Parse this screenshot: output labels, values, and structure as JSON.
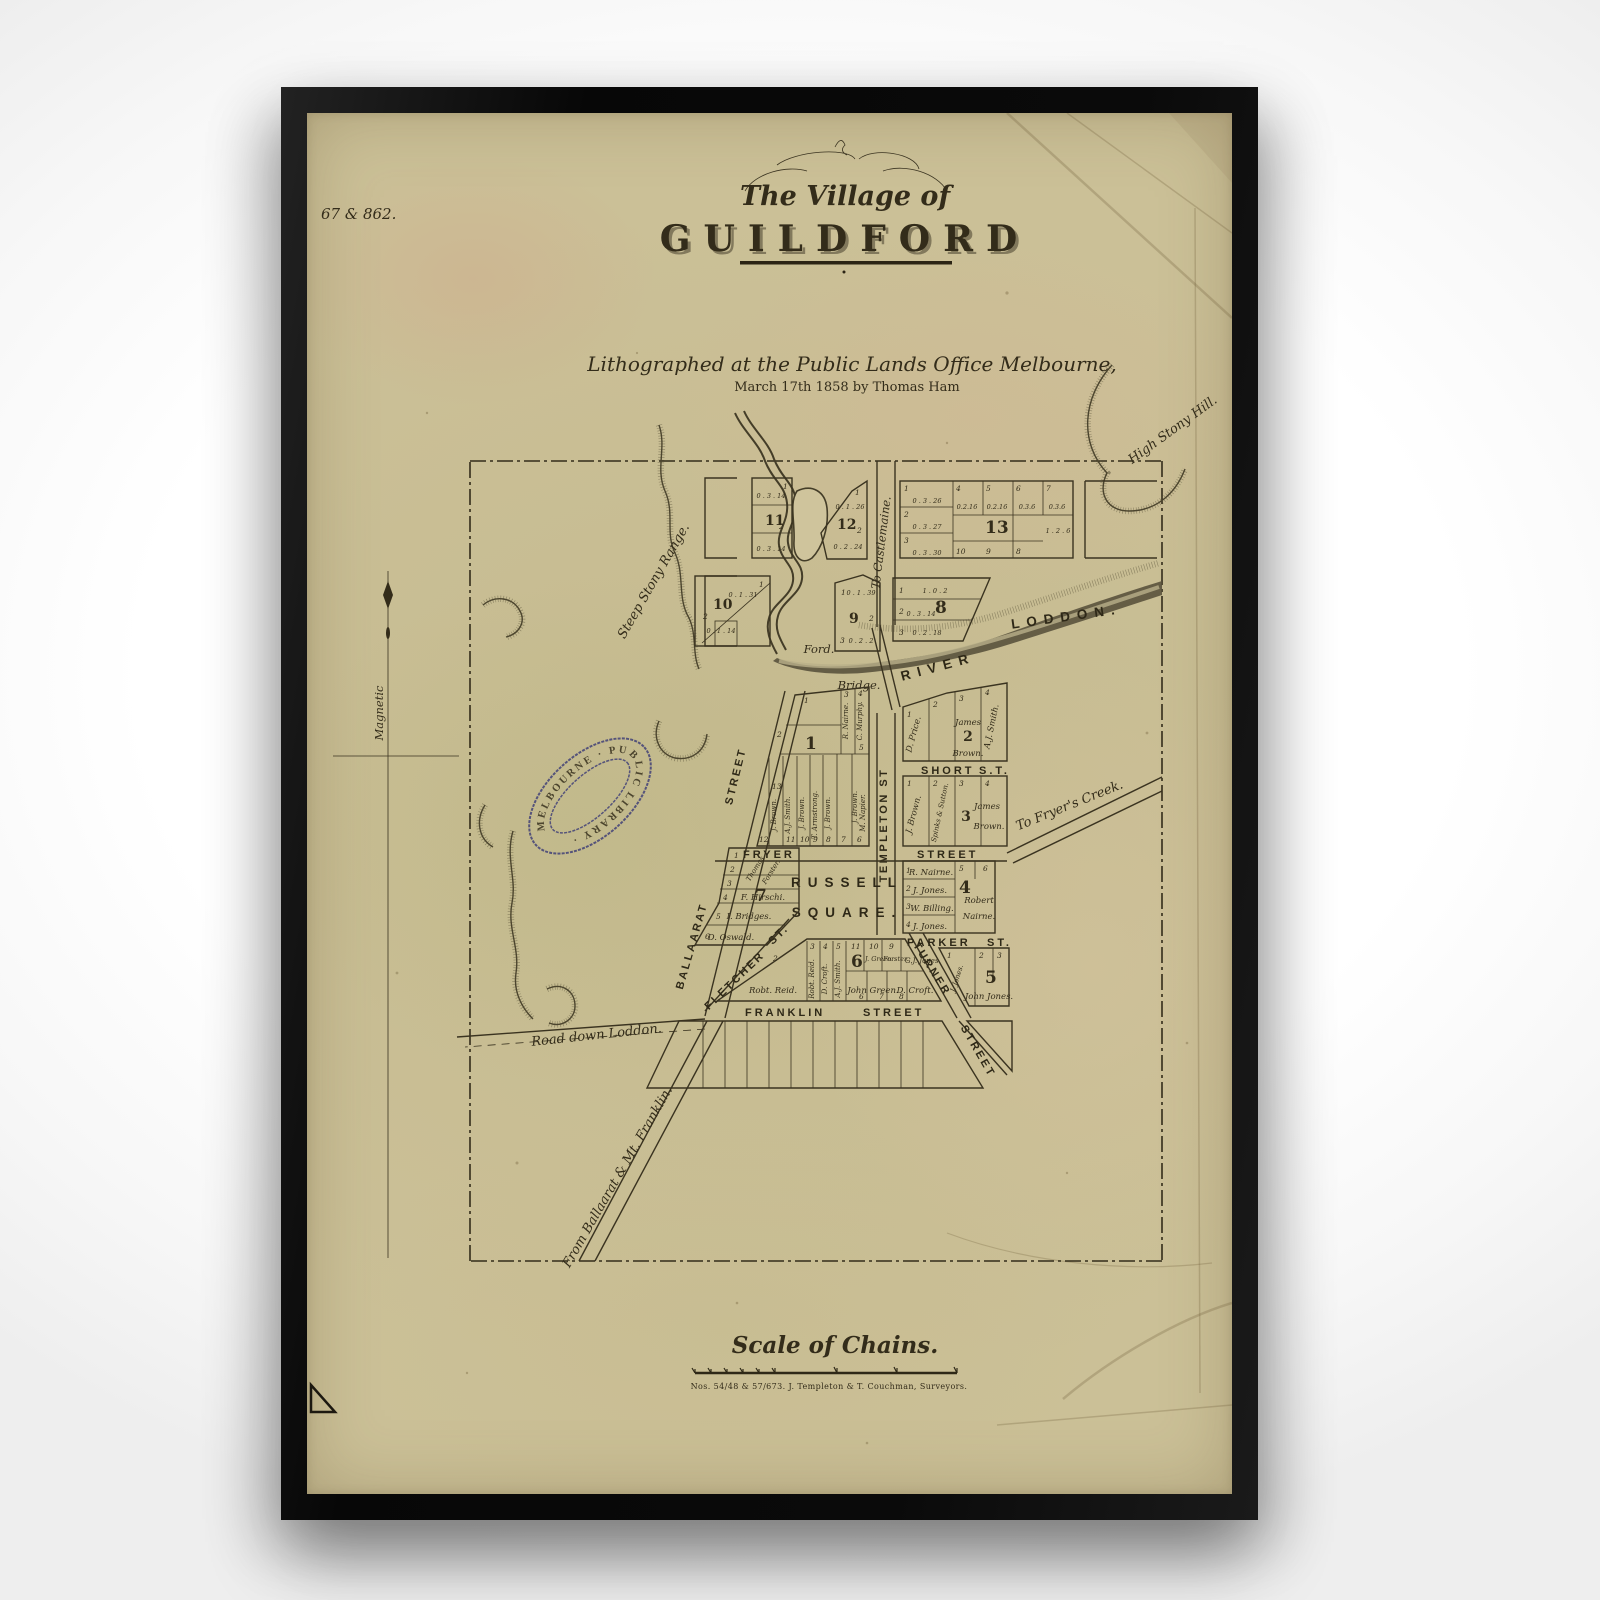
{
  "colors": {
    "paper": "#cbc097",
    "ink": "#332c1a",
    "stamp": "#3d3d77",
    "frame": "#0a0a0a"
  },
  "map": {
    "plate": "67 & 862.",
    "title": {
      "line1": "The Village of",
      "line2": "GUILDFORD"
    },
    "imprint": {
      "line1": "Lithographed at the Public Lands Office Melbourne,",
      "line2": "March 17th 1858 by Thomas Ham"
    },
    "compass": {
      "label": "Magnetic"
    },
    "stamp": {
      "text": "MELBOURNE · PUBLIC LIBRARY ·"
    },
    "features": {
      "high_stony_hill": "High  Stony  Hill.",
      "steep_stony_range": "Steep  Stony  Range.",
      "to_castlemaine": "To Castlemaine.",
      "river": "RIVER",
      "loddon": "LODDON.",
      "ford": "Ford.",
      "bridge": "Bridge.",
      "to_fryers_creek": "To Fryer's Creek.",
      "road_down_loddon": "Road down Loddon.",
      "from_ballaarat": "From Ballaarat & Mt. Franklin."
    },
    "streets": {
      "templeton": "TEMPLETON  ST",
      "short": "SHORT",
      "short_abbr": "S.T.",
      "fryer": "FRYER",
      "fryer_word": "STREET",
      "parker": "PARKER",
      "parker_abbr": "ST.",
      "fletcher": "FLETCHER",
      "fletcher_abbr": "ST.",
      "turner": "TURNER",
      "turner_word": "STREET",
      "franklin": "FRANKLIN",
      "franklin_word": "STREET",
      "ballaarat": "BALLAARAT",
      "ballaarat_word": "STREET",
      "russell": "RUSSELL",
      "square": "SQUARE."
    },
    "blocks": {
      "b1": {
        "num": "1",
        "top_nums": [
          "1",
          "2",
          "3",
          "4",
          "5"
        ],
        "bottom_nums": [
          "12",
          "13",
          "11",
          "10",
          "9",
          "8",
          "7",
          "6"
        ],
        "owners": [
          "J. Brown.",
          "A.J. Smith.",
          "J. Brown.",
          "T. Armstrong.",
          "J. Brown.",
          "J. Brown.",
          "M. Napier.",
          "R. Nairne.",
          "C. Murphy."
        ]
      },
      "b2": {
        "num": "2",
        "nums": [
          "1",
          "2",
          "3",
          "4"
        ],
        "owners": [
          "D. Price.",
          "James",
          "Brown.",
          "A.J. Smith."
        ]
      },
      "b3": {
        "num": "3",
        "nums": [
          "1",
          "2",
          "3",
          "4"
        ],
        "owners": [
          "J. Brown.",
          "Spinks & Sutton.",
          "James",
          "Brown."
        ]
      },
      "b4": {
        "num": "4",
        "nums": [
          "1",
          "2",
          "3",
          "4",
          "5",
          "6"
        ],
        "owners": [
          "R. Nairne.",
          "J. Jones.",
          "W. Billing.",
          "J. Jones.",
          "Robert",
          "Nairne."
        ]
      },
      "b5": {
        "num": "5",
        "nums": [
          "1",
          "2",
          "3"
        ],
        "owners": [
          "J. Jones.",
          "John Jones."
        ]
      },
      "b6": {
        "num": "6",
        "lot2": "2",
        "top_nums": [
          "3",
          "4",
          "5",
          "11",
          "10",
          "9"
        ],
        "bottom_nums": [
          "6",
          "7",
          "8"
        ],
        "owners": [
          "Robt. Reid.",
          "Robt. Reid.",
          "D. Croft.",
          "A.J. Smith.",
          "J. Green.",
          "Forster.",
          "G.J. Jones.",
          "John Green.",
          "D. Croft."
        ]
      },
      "b7": {
        "num": "7",
        "nums": [
          "1",
          "2",
          "3",
          "4",
          "5",
          "6"
        ],
        "owners": [
          "Thomas",
          "Forster.",
          "F. Hirschi.",
          "I. Bridges.",
          "D. Oswald."
        ]
      },
      "b8": {
        "num": "8",
        "nums": [
          "1",
          "2",
          "3"
        ],
        "areas": [
          "1 . 0 . 2",
          "0 . 3 . 14",
          "0 . 2 . 18"
        ]
      },
      "b9": {
        "num": "9",
        "nums": [
          "1",
          "2",
          "3"
        ],
        "areas": [
          "0 . 1 . 39",
          "0 . 2 . 2"
        ]
      },
      "b10": {
        "num": "10",
        "nums": [
          "1",
          "2"
        ],
        "areas": [
          "0 . 1 . 31",
          "0 . 1 . 14"
        ]
      },
      "b11": {
        "num": "11",
        "nums": [
          "1",
          "2"
        ],
        "areas": [
          "0 . 3 . 14",
          "0 . 3 . 14"
        ]
      },
      "b12": {
        "num": "12",
        "nums": [
          "1",
          "2"
        ],
        "areas": [
          "0 . 1 . 26",
          "0 . 2 . 24"
        ]
      },
      "b13": {
        "num": "13",
        "left_nums": [
          "1",
          "2",
          "3"
        ],
        "left_areas": [
          "0 . 3 . 26",
          "0 . 3 . 27",
          "0 . 3 . 30"
        ],
        "top_nums": [
          "4",
          "5",
          "6",
          "7"
        ],
        "top_areas": [
          "0.2.16",
          "0.2.16",
          "0.3.6",
          "0.3.6"
        ],
        "bottom_nums": [
          "10",
          "9",
          "8"
        ],
        "corner_area": "1 . 2 . 6"
      }
    },
    "scale": {
      "title": "Scale of Chains.",
      "note": "Nos. 54/48 & 57/673.   J. Templeton & T. Couchman, Surveyors."
    }
  }
}
